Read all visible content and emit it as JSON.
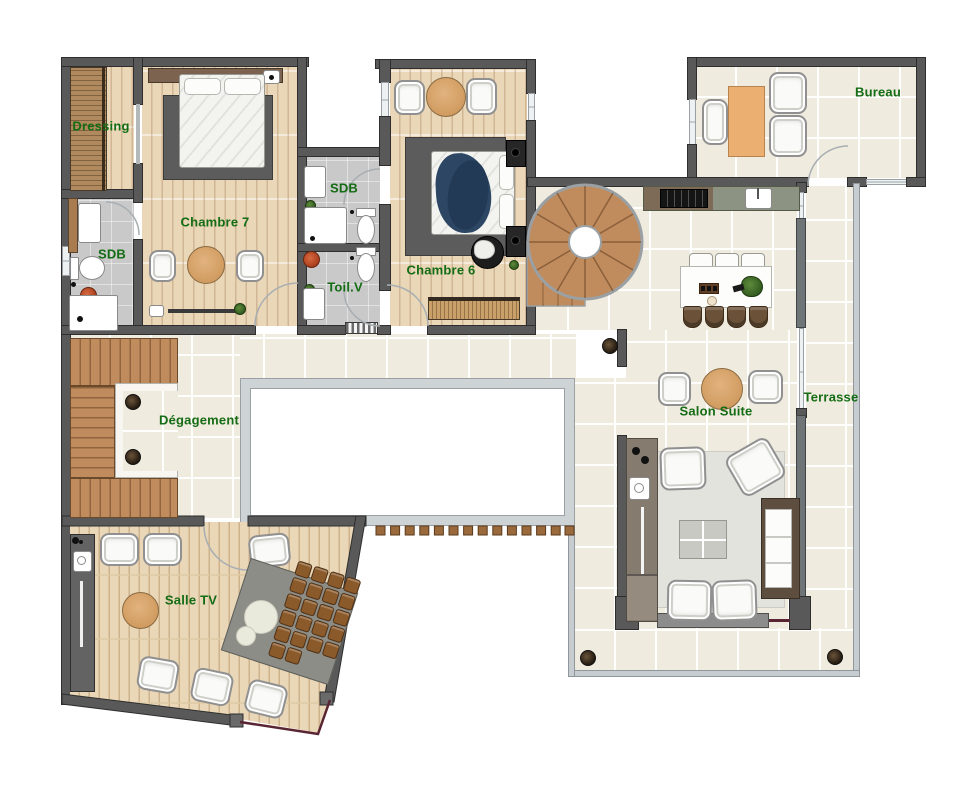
{
  "labels": {
    "dressing": "Dressing",
    "chambre7": "Chambre 7",
    "sdb_left": "SDB",
    "sdb": "SDB",
    "toil_v": "Toil.V",
    "chambre6": "Chambre 6",
    "bureau": "Bureau",
    "degagement": "Dégagement",
    "salon_suite": "Salon Suite",
    "terrasse": "Terrasse",
    "salle_tv": "Salle TV"
  },
  "colors": {
    "label_text": "#146c14",
    "wall": "#595959",
    "tile_floor": "#f0ebdf",
    "wood_floor": "#e9d7b8",
    "bath_floor": "#c9c9c9",
    "stair_wood": "#c18c5d",
    "round_table": "#d9a870",
    "cinema_seat": "#8b5a2b",
    "glass_line": "#5a2533",
    "railing": "#c6cccf",
    "navy_bedding": "#2c4663",
    "desk": "#ecaf72"
  }
}
